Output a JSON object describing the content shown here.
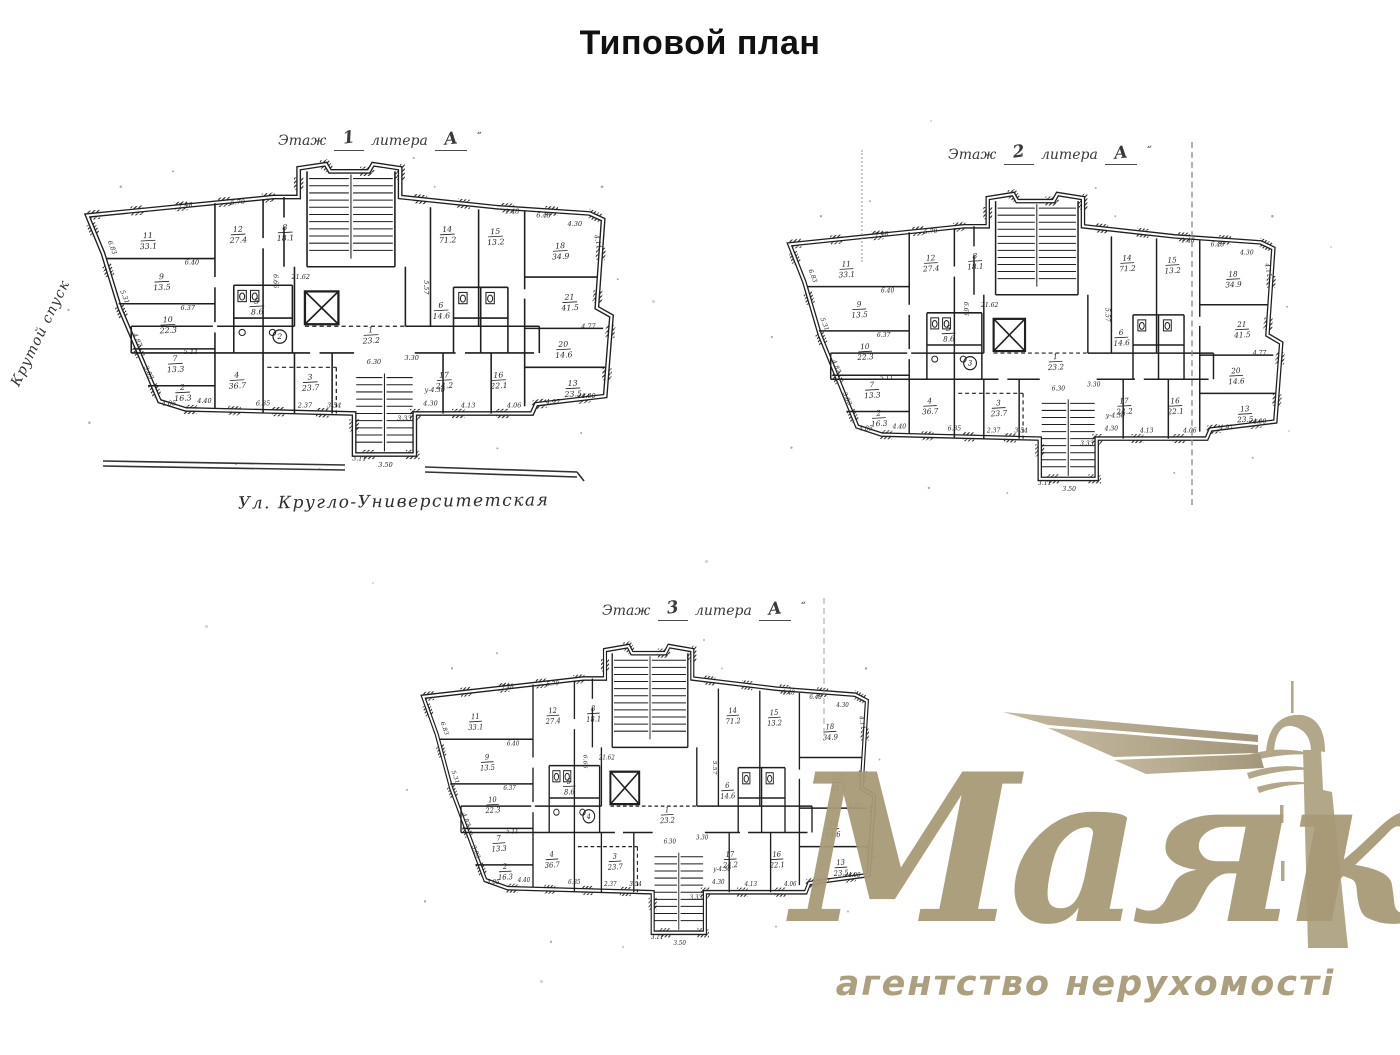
{
  "page": {
    "title": "Типовой план"
  },
  "plans": [
    {
      "label": {
        "prefix": "Этаж",
        "number": "1",
        "word": "литера",
        "value": "А",
        "mark": "“"
      },
      "circle_mark": "2"
    },
    {
      "label": {
        "prefix": "Этаж",
        "number": "2",
        "word": "литера",
        "value": "А",
        "mark": "“"
      },
      "circle_mark": "3"
    },
    {
      "label": {
        "prefix": "Этаж",
        "number": "3",
        "word": "литера",
        "value": "А",
        "mark": "“"
      },
      "circle_mark": "4"
    }
  ],
  "street_label": "Ул. Кругло-Университетская",
  "side_street_label": "Крутой спуск",
  "watermark": {
    "brand": "Маяк",
    "tagline": "агентство нерухомості",
    "color": "#a89a77",
    "icon": "lighthouse-icon"
  },
  "plan_template": {
    "ink_color": "#1f1f1f",
    "rooms": [
      {
        "n": "11",
        "a": "33.1",
        "x": 86,
        "y": 80
      },
      {
        "n": "9",
        "a": "13.5",
        "x": 99,
        "y": 120
      },
      {
        "n": "10",
        "a": "22.3",
        "x": 105,
        "y": 162
      },
      {
        "n": "7",
        "a": "13.3",
        "x": 112,
        "y": 200
      },
      {
        "n": "2",
        "a": "16.3",
        "x": 119,
        "y": 228
      },
      {
        "n": "12",
        "a": "27.4",
        "x": 172,
        "y": 74
      },
      {
        "n": "8",
        "a": "18.1",
        "x": 217,
        "y": 72
      },
      {
        "n": "14",
        "a": "71.2",
        "x": 372,
        "y": 74
      },
      {
        "n": "15",
        "a": "13.2",
        "x": 418,
        "y": 76
      },
      {
        "n": "18",
        "a": "34.9",
        "x": 480,
        "y": 90
      },
      {
        "n": "21",
        "a": "41.5",
        "x": 489,
        "y": 140
      },
      {
        "n": "20",
        "a": "14.6",
        "x": 483,
        "y": 186
      },
      {
        "n": "4",
        "a": "36.7",
        "x": 171,
        "y": 216
      },
      {
        "n": "3",
        "a": "23.7",
        "x": 241,
        "y": 218
      },
      {
        "n": "17",
        "a": "24.2",
        "x": 369,
        "y": 216
      },
      {
        "n": "16",
        "a": "22.1",
        "x": 421,
        "y": 216
      },
      {
        "n": "13",
        "a": "23.5",
        "x": 492,
        "y": 224
      },
      {
        "n": "5",
        "a": "8.6",
        "x": 190,
        "y": 144
      },
      {
        "n": "6",
        "a": "14.6",
        "x": 366,
        "y": 148
      },
      {
        "n": "1",
        "a": "23.2",
        "x": 299,
        "y": 172
      }
    ],
    "dims": [
      {
        "t": "7.48",
        "x": 122,
        "y": 50,
        "r": -6
      },
      {
        "t": "5.70",
        "x": 172,
        "y": 47,
        "r": -4
      },
      {
        "t": "1.48",
        "x": 434,
        "y": 56,
        "r": 0
      },
      {
        "t": "6.48",
        "x": 464,
        "y": 60,
        "r": 0
      },
      {
        "t": "4.30",
        "x": 494,
        "y": 68,
        "r": 0
      },
      {
        "t": "4.11",
        "x": 514,
        "y": 84,
        "r": 78
      },
      {
        "t": "6.83",
        "x": 50,
        "y": 90,
        "r": 68
      },
      {
        "t": "5.31",
        "x": 62,
        "y": 138,
        "r": 68
      },
      {
        "t": "4.87",
        "x": 74,
        "y": 180,
        "r": 68
      },
      {
        "t": "3.83",
        "x": 85,
        "y": 212,
        "r": 65
      },
      {
        "t": "4.85",
        "x": 106,
        "y": 243,
        "r": 0
      },
      {
        "t": "6.40",
        "x": 128,
        "y": 106,
        "r": 0
      },
      {
        "t": "6.37",
        "x": 124,
        "y": 150,
        "r": 0
      },
      {
        "t": "5.11",
        "x": 127,
        "y": 193,
        "r": 0
      },
      {
        "t": "4.40",
        "x": 140,
        "y": 241,
        "r": 0
      },
      {
        "t": "6.35",
        "x": 196,
        "y": 243,
        "r": 0
      },
      {
        "t": "2.37",
        "x": 236,
        "y": 245,
        "r": 0
      },
      {
        "t": "3.54",
        "x": 264,
        "y": 245,
        "r": 0
      },
      {
        "t": "6.30",
        "x": 302,
        "y": 203,
        "r": 0
      },
      {
        "t": "3.30",
        "x": 338,
        "y": 199,
        "r": 0
      },
      {
        "t": "у-4.30",
        "x": 360,
        "y": 230,
        "r": 0
      },
      {
        "t": "4.30",
        "x": 356,
        "y": 243,
        "r": 0
      },
      {
        "t": "4.13",
        "x": 392,
        "y": 245,
        "r": 0
      },
      {
        "t": "4.06",
        "x": 436,
        "y": 245,
        "r": 0
      },
      {
        "t": "4.97",
        "x": 473,
        "y": 242,
        "r": 0
      },
      {
        "t": "4.00",
        "x": 507,
        "y": 236,
        "r": 0
      },
      {
        "t": "4.77",
        "x": 507,
        "y": 168,
        "r": 0
      },
      {
        "t": "5.57",
        "x": 350,
        "y": 128,
        "r": 90
      },
      {
        "t": "6.66",
        "x": 206,
        "y": 122,
        "r": 90
      },
      {
        "t": "21.62",
        "x": 232,
        "y": 120,
        "r": 0
      },
      {
        "t": "3.50",
        "x": 313,
        "y": 303,
        "r": 0
      },
      {
        "t": "3.11",
        "x": 288,
        "y": 297,
        "r": 0
      },
      {
        "t": "3.33",
        "x": 331,
        "y": 258,
        "r": 0
      }
    ],
    "circle_pos": {
      "x": 212,
      "y": 176
    }
  }
}
